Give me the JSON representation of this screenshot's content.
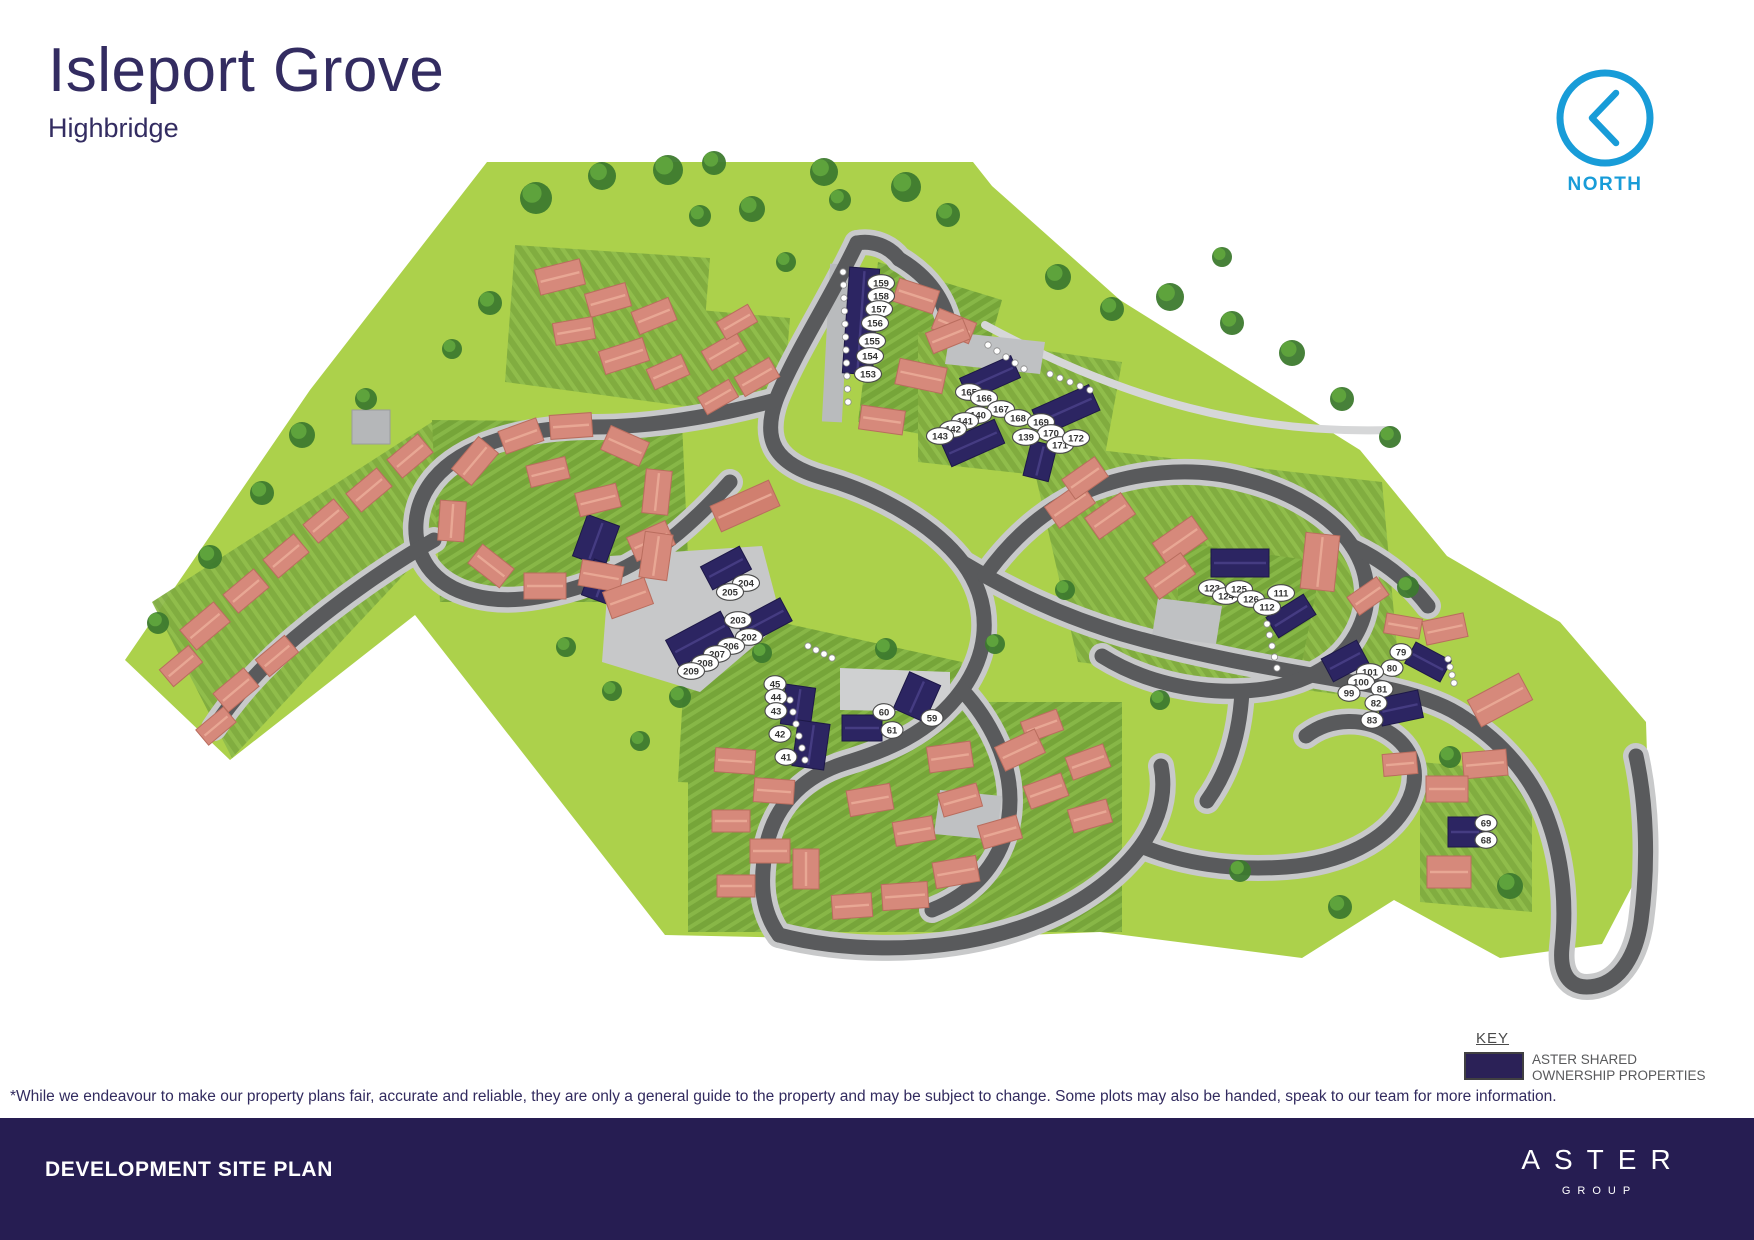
{
  "header": {
    "title": "Isleport Grove",
    "subtitle": "Highbridge"
  },
  "north": {
    "label": "NORTH"
  },
  "key": {
    "heading": "KEY",
    "label_line1": "ASTER SHARED",
    "label_line2": "OWNERSHIP PROPERTIES"
  },
  "disclaimer": "*While we endeavour to make our property plans fair, accurate and reliable, they are only a general guide to the property and may be subject to change. Some plots may also be handed, speak to our team for more information.",
  "footer": {
    "title": "DEVELOPMENT SITE PLAN",
    "brand": "ASTER",
    "brand_sub": "GROUP"
  },
  "colors": {
    "brand_navy": "#261d52",
    "title_navy": "#332c61",
    "north_blue": "#189cd8",
    "shared_ownership_navy": "#2b2157",
    "roof_salmon": "#d6897b",
    "field_green": "#acd14b",
    "garden_green": "#7fab3f",
    "road_gray": "#595a5c"
  },
  "map": {
    "colors": {
      "navy": "#2c2562",
      "roof": "#d6897b"
    },
    "plot_labels": [
      {
        "n": "159",
        "x": 881,
        "y": 283
      },
      {
        "n": "158",
        "x": 881,
        "y": 296
      },
      {
        "n": "157",
        "x": 879,
        "y": 309
      },
      {
        "n": "156",
        "x": 875,
        "y": 323
      },
      {
        "n": "155",
        "x": 872,
        "y": 341
      },
      {
        "n": "154",
        "x": 870,
        "y": 356
      },
      {
        "n": "153",
        "x": 868,
        "y": 374
      },
      {
        "n": "165",
        "x": 969,
        "y": 392
      },
      {
        "n": "166",
        "x": 984,
        "y": 398
      },
      {
        "n": "167",
        "x": 1001,
        "y": 409
      },
      {
        "n": "168",
        "x": 1018,
        "y": 418
      },
      {
        "n": "169",
        "x": 1041,
        "y": 422
      },
      {
        "n": "170",
        "x": 1051,
        "y": 433
      },
      {
        "n": "171",
        "x": 1060,
        "y": 445
      },
      {
        "n": "172",
        "x": 1076,
        "y": 438
      },
      {
        "n": "139",
        "x": 1026,
        "y": 437
      },
      {
        "n": "140",
        "x": 978,
        "y": 415
      },
      {
        "n": "141",
        "x": 965,
        "y": 421
      },
      {
        "n": "142",
        "x": 953,
        "y": 429
      },
      {
        "n": "143",
        "x": 940,
        "y": 436
      },
      {
        "n": "204",
        "x": 746,
        "y": 583
      },
      {
        "n": "205",
        "x": 730,
        "y": 592
      },
      {
        "n": "203",
        "x": 738,
        "y": 620
      },
      {
        "n": "202",
        "x": 749,
        "y": 637
      },
      {
        "n": "206",
        "x": 731,
        "y": 646
      },
      {
        "n": "207",
        "x": 717,
        "y": 654
      },
      {
        "n": "208",
        "x": 705,
        "y": 663
      },
      {
        "n": "209",
        "x": 691,
        "y": 671
      },
      {
        "n": "45",
        "x": 775,
        "y": 684
      },
      {
        "n": "44",
        "x": 776,
        "y": 697
      },
      {
        "n": "43",
        "x": 776,
        "y": 711
      },
      {
        "n": "42",
        "x": 780,
        "y": 734
      },
      {
        "n": "41",
        "x": 786,
        "y": 757
      },
      {
        "n": "60",
        "x": 884,
        "y": 712
      },
      {
        "n": "61",
        "x": 892,
        "y": 730
      },
      {
        "n": "59",
        "x": 932,
        "y": 718
      },
      {
        "n": "123",
        "x": 1212,
        "y": 588
      },
      {
        "n": "124",
        "x": 1226,
        "y": 596
      },
      {
        "n": "125",
        "x": 1239,
        "y": 589
      },
      {
        "n": "126",
        "x": 1251,
        "y": 599
      },
      {
        "n": "111",
        "x": 1281,
        "y": 593
      },
      {
        "n": "112",
        "x": 1267,
        "y": 607
      },
      {
        "n": "79",
        "x": 1401,
        "y": 652
      },
      {
        "n": "80",
        "x": 1392,
        "y": 668
      },
      {
        "n": "101",
        "x": 1370,
        "y": 672
      },
      {
        "n": "100",
        "x": 1361,
        "y": 682
      },
      {
        "n": "99",
        "x": 1349,
        "y": 693
      },
      {
        "n": "81",
        "x": 1382,
        "y": 689
      },
      {
        "n": "82",
        "x": 1376,
        "y": 703
      },
      {
        "n": "83",
        "x": 1372,
        "y": 720
      },
      {
        "n": "69",
        "x": 1486,
        "y": 823
      },
      {
        "n": "68",
        "x": 1486,
        "y": 840
      }
    ],
    "buildings": [
      [
        861,
        321,
        30,
        106,
        4,
        "n"
      ],
      [
        990,
        378,
        56,
        24,
        -24,
        "n"
      ],
      [
        1066,
        410,
        62,
        28,
        -24,
        "n"
      ],
      [
        973,
        443,
        58,
        26,
        -24,
        "n"
      ],
      [
        1040,
        461,
        26,
        36,
        14,
        "n"
      ],
      [
        596,
        541,
        34,
        44,
        20,
        "n"
      ],
      [
        602,
        582,
        30,
        38,
        20,
        "n"
      ],
      [
        726,
        568,
        44,
        26,
        -28,
        "n"
      ],
      [
        764,
        621,
        50,
        26,
        -28,
        "n"
      ],
      [
        700,
        639,
        62,
        30,
        -28,
        "n"
      ],
      [
        798,
        706,
        30,
        40,
        8,
        "n"
      ],
      [
        811,
        745,
        32,
        46,
        8,
        "n"
      ],
      [
        862,
        728,
        40,
        26,
        0,
        "n"
      ],
      [
        917,
        697,
        34,
        40,
        24,
        "n"
      ],
      [
        1240,
        563,
        58,
        28,
        0,
        "n"
      ],
      [
        1291,
        616,
        44,
        24,
        -32,
        "n"
      ],
      [
        1428,
        662,
        40,
        24,
        28,
        "n"
      ],
      [
        1400,
        708,
        42,
        28,
        -12,
        "n"
      ],
      [
        1345,
        661,
        40,
        26,
        -28,
        "n"
      ],
      [
        1465,
        832,
        34,
        30,
        0,
        "n"
      ],
      [
        560,
        277,
        46,
        26,
        -14,
        "h"
      ],
      [
        608,
        300,
        42,
        24,
        -16,
        "h"
      ],
      [
        654,
        316,
        40,
        24,
        -22,
        "h"
      ],
      [
        574,
        331,
        40,
        22,
        -10,
        "h"
      ],
      [
        624,
        356,
        46,
        24,
        -18,
        "h"
      ],
      [
        668,
        372,
        38,
        22,
        -24,
        "h"
      ],
      [
        724,
        351,
        40,
        22,
        -30,
        "h"
      ],
      [
        757,
        377,
        40,
        22,
        -30,
        "h"
      ],
      [
        718,
        397,
        36,
        20,
        -30,
        "h"
      ],
      [
        737,
        322,
        36,
        20,
        -30,
        "h"
      ],
      [
        916,
        296,
        42,
        24,
        18,
        "h"
      ],
      [
        954,
        326,
        40,
        22,
        22,
        "h"
      ],
      [
        921,
        376,
        48,
        26,
        12,
        "h"
      ],
      [
        882,
        420,
        44,
        24,
        8,
        "h"
      ],
      [
        948,
        336,
        40,
        22,
        -22,
        "h"
      ],
      [
        1070,
        505,
        44,
        26,
        -35,
        "h"
      ],
      [
        1110,
        516,
        44,
        26,
        -35,
        "h"
      ],
      [
        1180,
        541,
        48,
        28,
        -35,
        "h"
      ],
      [
        1170,
        576,
        44,
        26,
        -35,
        "h"
      ],
      [
        1085,
        478,
        40,
        24,
        -35,
        "h"
      ],
      [
        1320,
        562,
        34,
        56,
        6,
        "h"
      ],
      [
        1403,
        626,
        36,
        20,
        10,
        "h"
      ],
      [
        1445,
        629,
        42,
        24,
        -12,
        "h"
      ],
      [
        1500,
        700,
        58,
        30,
        -28,
        "h"
      ],
      [
        1485,
        764,
        44,
        26,
        -5,
        "h"
      ],
      [
        1400,
        764,
        34,
        22,
        -5,
        "h"
      ],
      [
        1368,
        596,
        36,
        22,
        -35,
        "h"
      ],
      [
        1447,
        789,
        42,
        26,
        0,
        "h"
      ],
      [
        1449,
        872,
        44,
        32,
        0,
        "h"
      ],
      [
        735,
        761,
        40,
        24,
        4,
        "h"
      ],
      [
        774,
        791,
        40,
        24,
        4,
        "h"
      ],
      [
        731,
        821,
        38,
        22,
        0,
        "h"
      ],
      [
        770,
        851,
        40,
        24,
        0,
        "h"
      ],
      [
        736,
        886,
        38,
        22,
        0,
        "h"
      ],
      [
        806,
        869,
        26,
        40,
        0,
        "h"
      ],
      [
        870,
        800,
        44,
        26,
        -10,
        "h"
      ],
      [
        914,
        831,
        40,
        24,
        -10,
        "h"
      ],
      [
        960,
        800,
        40,
        24,
        -16,
        "h"
      ],
      [
        1000,
        832,
        40,
        24,
        -16,
        "h"
      ],
      [
        956,
        872,
        44,
        26,
        -10,
        "h"
      ],
      [
        1046,
        791,
        40,
        24,
        -20,
        "h"
      ],
      [
        1088,
        762,
        40,
        24,
        -20,
        "h"
      ],
      [
        1042,
        726,
        38,
        22,
        -20,
        "h"
      ],
      [
        905,
        896,
        46,
        26,
        -4,
        "h"
      ],
      [
        852,
        906,
        40,
        24,
        -4,
        "h"
      ],
      [
        1090,
        816,
        40,
        24,
        -16,
        "h"
      ],
      [
        950,
        757,
        44,
        26,
        -8,
        "h"
      ],
      [
        1020,
        750,
        44,
        26,
        -25,
        "h"
      ],
      [
        475,
        461,
        42,
        26,
        -50,
        "h"
      ],
      [
        521,
        436,
        40,
        24,
        -20,
        "h"
      ],
      [
        571,
        426,
        42,
        24,
        -4,
        "h"
      ],
      [
        625,
        446,
        42,
        26,
        24,
        "h"
      ],
      [
        657,
        492,
        26,
        44,
        6,
        "h"
      ],
      [
        651,
        541,
        42,
        26,
        -24,
        "h"
      ],
      [
        601,
        576,
        42,
        26,
        10,
        "h"
      ],
      [
        545,
        586,
        42,
        26,
        0,
        "h"
      ],
      [
        491,
        566,
        40,
        24,
        38,
        "h"
      ],
      [
        452,
        521,
        26,
        40,
        4,
        "h"
      ],
      [
        205,
        626,
        44,
        26,
        -40,
        "h"
      ],
      [
        246,
        591,
        40,
        24,
        -40,
        "h"
      ],
      [
        286,
        556,
        40,
        24,
        -40,
        "h"
      ],
      [
        326,
        521,
        40,
        24,
        -40,
        "h"
      ],
      [
        369,
        490,
        40,
        24,
        -40,
        "h"
      ],
      [
        410,
        456,
        40,
        24,
        -40,
        "h"
      ],
      [
        181,
        666,
        38,
        22,
        -40,
        "h"
      ],
      [
        236,
        690,
        40,
        24,
        -40,
        "h"
      ],
      [
        277,
        656,
        38,
        22,
        -40,
        "h"
      ],
      [
        216,
        726,
        36,
        20,
        -40,
        "h"
      ],
      [
        628,
        598,
        44,
        28,
        -20,
        "h"
      ],
      [
        656,
        556,
        28,
        46,
        8,
        "h"
      ],
      [
        598,
        500,
        42,
        24,
        -14,
        "h"
      ],
      [
        548,
        472,
        40,
        22,
        -14,
        "h"
      ],
      [
        745,
        506,
        64,
        28,
        -24,
        "b"
      ]
    ],
    "trees": [
      [
        536,
        198,
        16
      ],
      [
        602,
        176,
        14
      ],
      [
        668,
        170,
        15
      ],
      [
        714,
        163,
        12
      ],
      [
        752,
        209,
        13
      ],
      [
        824,
        172,
        14
      ],
      [
        840,
        200,
        11
      ],
      [
        906,
        187,
        15
      ],
      [
        948,
        215,
        12
      ],
      [
        700,
        216,
        11
      ],
      [
        786,
        262,
        10
      ],
      [
        1058,
        277,
        13
      ],
      [
        1112,
        309,
        12
      ],
      [
        1170,
        297,
        14
      ],
      [
        1232,
        323,
        12
      ],
      [
        1292,
        353,
        13
      ],
      [
        1342,
        399,
        12
      ],
      [
        1390,
        437,
        11
      ],
      [
        1222,
        257,
        10
      ],
      [
        302,
        435,
        13
      ],
      [
        262,
        493,
        12
      ],
      [
        210,
        557,
        12
      ],
      [
        158,
        623,
        11
      ],
      [
        366,
        399,
        11
      ],
      [
        490,
        303,
        12
      ],
      [
        452,
        349,
        10
      ],
      [
        886,
        649,
        11
      ],
      [
        762,
        653,
        10
      ],
      [
        680,
        697,
        11
      ],
      [
        640,
        741,
        10
      ],
      [
        566,
        647,
        10
      ],
      [
        612,
        691,
        10
      ],
      [
        1408,
        587,
        11
      ],
      [
        1450,
        757,
        11
      ],
      [
        1510,
        886,
        13
      ],
      [
        1340,
        907,
        12
      ],
      [
        1240,
        871,
        11
      ],
      [
        995,
        644,
        10
      ],
      [
        1160,
        700,
        10
      ],
      [
        1065,
        590,
        10
      ]
    ],
    "parking_dot_rows": [
      [
        843,
        272,
        0.5,
        13,
        11
      ],
      [
        790,
        700,
        3,
        12,
        6
      ],
      [
        1267,
        624,
        2.5,
        11,
        5
      ],
      [
        1050,
        374,
        10,
        4,
        5
      ],
      [
        1448,
        659,
        2,
        8,
        4
      ],
      [
        988,
        345,
        9,
        6,
        5
      ],
      [
        808,
        646,
        8,
        4,
        4
      ]
    ]
  }
}
